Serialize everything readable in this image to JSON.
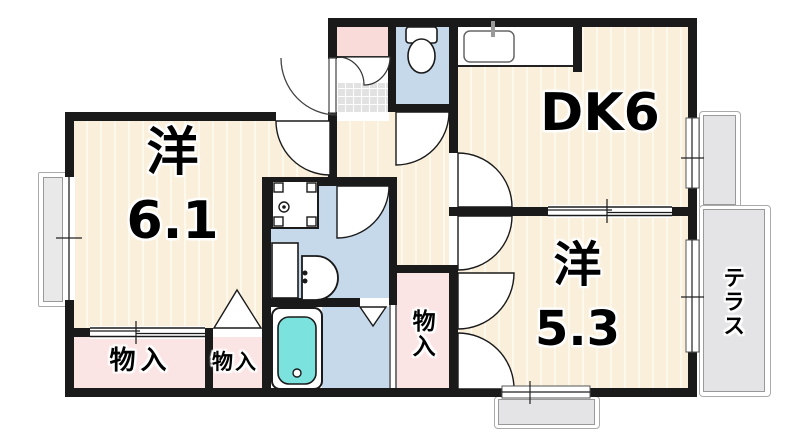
{
  "plan_type": "apartment-floorplan",
  "rooms": {
    "western_61": {
      "label": "洋",
      "size": "6.1"
    },
    "dk": {
      "label": "DK6"
    },
    "western_53": {
      "label": "洋",
      "size": "5.3"
    },
    "storage_left": {
      "label": "物入"
    },
    "storage_center": {
      "label": "物入"
    },
    "storage_hall": {
      "label": "物入"
    },
    "terrace": {
      "label": "テラス"
    }
  },
  "fixtures": [
    "toilet",
    "kitchen-sink",
    "washing-machine-pan",
    "washbasin",
    "bathtub",
    "entrance-tile"
  ],
  "colors": {
    "wall": "#1a1a1a",
    "wood_floor": "#F9EFDB",
    "closet_pink": "#FBE4E4",
    "wet_area_blue": "#C5D9EB",
    "bathtub_cyan": "#7BE2DE",
    "terrace_gray": "#E4E4E6",
    "entrance_tile_gray": "#E2E2E2"
  }
}
